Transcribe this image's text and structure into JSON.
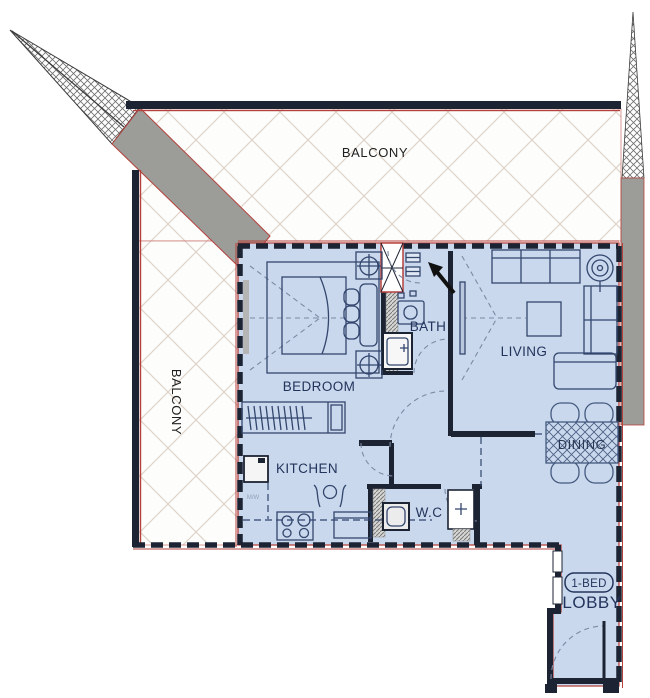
{
  "plan": {
    "unit_badge": "1-BED",
    "labels": {
      "balcony_top": "BALCONY",
      "balcony_left": "BALCONY",
      "bedroom": "BEDROOM",
      "kitchen": "KITCHEN",
      "bath": "BATH",
      "living": "LIVING",
      "wc": "W.C",
      "dining": "DINING",
      "lobby": "LOBBY",
      "microwave": "M/W"
    },
    "colors": {
      "room_fill": "#c9d8ec",
      "wall_black": "#1c2333",
      "accent_red": "#b5413c",
      "mass_gray": "#9c9c98",
      "furniture_line": "#33466e",
      "label_navy": "#22345c",
      "label_black": "#1f1f1f"
    }
  }
}
